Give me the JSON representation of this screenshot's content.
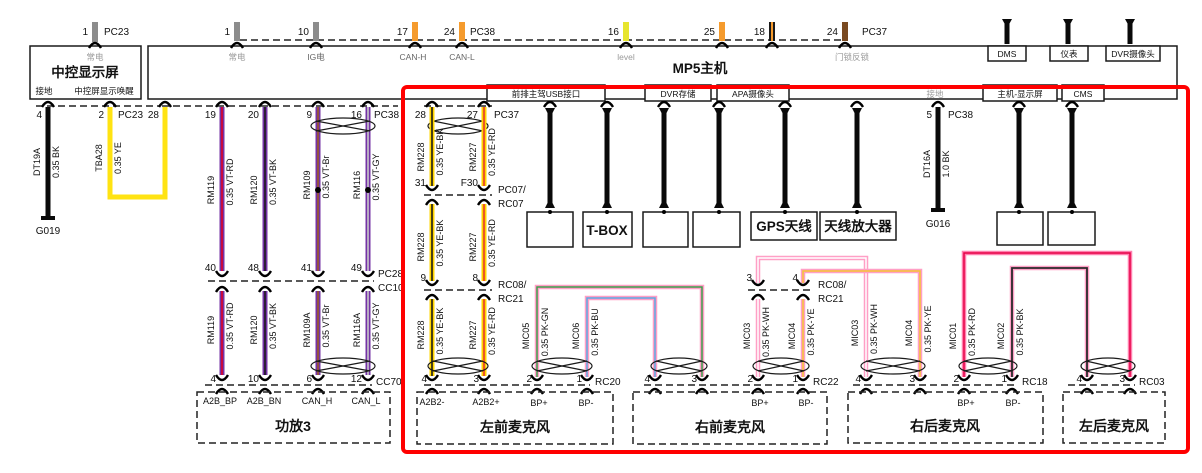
{
  "colors": {
    "red_frame": "#FF0000",
    "violet": "#7433A6",
    "yellow_wire": "#FFD400",
    "pale_yellow": "#FFE312",
    "pink_wire": "#FF9FC6",
    "black_wire": "#0A0A0A",
    "orange_stub": "#F59B2D",
    "brown_stub": "#7A4A21"
  },
  "screen": {
    "top_pin": "1",
    "top_conn": "PC23",
    "power_label": "常电",
    "title": "中控显示屏",
    "gnd_label": "接地",
    "wake_label": "中控屏显示唤醒",
    "pin_gnd": "4",
    "pin_wake": "2",
    "bottom_conn": "PC23"
  },
  "mp5": {
    "title": "MP5主机",
    "pin1": "1",
    "pin1_label": "常电",
    "pin10": "10",
    "pin10_label": "IG电",
    "pin17": "17",
    "pin17_label": "CAN-H",
    "pin24a": "24",
    "pin24a_conn": "PC38",
    "pin24a_label": "CAN-L",
    "pin16": "16",
    "pin16_label": "level",
    "pin25": "25",
    "pin18": "18",
    "pin24b": "24",
    "pin24b_conn": "PC37",
    "pin24b_label": "门锁反锁",
    "box_dms": "DMS",
    "box_cluster": "仪表",
    "box_dvr_cam": "DVR摄像头",
    "box_usb": "前排主驾USB接口",
    "box_dvr_storage": "DVR存储",
    "box_apa": "APA摄像头",
    "gnd_label": "接地",
    "box_host_display": "主机-显示屏",
    "box_cms": "CMS"
  },
  "gnd_left": {
    "pin": "4",
    "name": "DT19A",
    "spec": "0.35 BK",
    "gnd": "G019"
  },
  "wake_wire": {
    "pin": "2",
    "conn": "PC23",
    "name": "TBA28",
    "spec": "0.35 YE",
    "pin_right": "28"
  },
  "purple": {
    "p19": "19",
    "p20": "20",
    "p9": "9",
    "p16": "16",
    "conn_top": "PC38",
    "w1": {
      "name": "RM119",
      "spec": "0.35 VT-RD"
    },
    "w2": {
      "name": "RM120",
      "spec": "0.35 VT-BK"
    },
    "w3": {
      "name": "RM109",
      "spec": "0.35 VT-Br"
    },
    "w4": {
      "name": "RM116",
      "spec": "0.35 VT-GY"
    },
    "m40": "40",
    "m48": "48",
    "m41": "41",
    "m49": "49",
    "conn_mid_a": "PC28",
    "conn_mid_b": "CC10",
    "w1b": {
      "name": "RM119",
      "spec": "0.35 VT-RD"
    },
    "w2b": {
      "name": "RM120",
      "spec": "0.35 VT-BK"
    },
    "w3b": {
      "name": "RM109A",
      "spec": "0.35 VT-Br"
    },
    "w4b": {
      "name": "RM116A",
      "spec": "0.35 VT-GY"
    },
    "b4": "4",
    "b10": "10",
    "b6": "6",
    "b12": "12",
    "conn_bot": "CC70"
  },
  "amp": {
    "title": "功放3",
    "l1": "A2B_BP",
    "l2": "A2B_BN",
    "l3": "CAN_H",
    "l4": "CAN_L"
  },
  "a2b": {
    "p28": "28",
    "p27": "27",
    "conn_top": "PC37",
    "s1w1": {
      "name": "RM228",
      "spec": "0.35 YE-BK"
    },
    "s1w2": {
      "name": "RM227",
      "spec": "0.35 YE-RD"
    },
    "p31": "31",
    "pF30": "F30",
    "conn2a": "PC07/",
    "conn2b": "RC07",
    "s2w1": {
      "name": "RM228",
      "spec": "0.35 YE-BK"
    },
    "s2w2": {
      "name": "RM227",
      "spec": "0.35 YE-RD"
    },
    "p9": "9",
    "p8": "8",
    "conn3a": "RC08/",
    "conn3b": "RC21",
    "s3w1": {
      "name": "RM228",
      "spec": "0.35 YE-BK"
    },
    "s3w2": {
      "name": "RM227",
      "spec": "0.35 YE-RD"
    }
  },
  "mic_lf": {
    "title": "左前麦克风",
    "p4": "4",
    "p3": "3",
    "p2": "2",
    "p1": "1",
    "conn": "RC20",
    "a2b_m": "A2B2-",
    "a2b_p": "A2B2+",
    "bp_p": "BP+",
    "bp_m": "BP-",
    "w1": {
      "name": "MIC05",
      "spec": "0.35 PK-GN"
    },
    "w2": {
      "name": "MIC06",
      "spec": "0.35 PK-BU"
    }
  },
  "mic_rf": {
    "title": "右前麦克风",
    "p4": "4",
    "p3": "3",
    "p2": "2",
    "p1": "1",
    "conn": "RC22",
    "bp_p": "BP+",
    "bp_m": "BP-",
    "w1": {
      "name": "MIC03",
      "spec": "0.35 PK-WH"
    },
    "w2": {
      "name": "MIC04",
      "spec": "0.35 PK-YE"
    },
    "up_p3": "3",
    "up_p4": "4",
    "up_conn_a": "RC08/",
    "up_conn_b": "RC21"
  },
  "mic_rr": {
    "title": "右后麦克风",
    "p4": "4",
    "p3": "3",
    "p2": "2",
    "p1": "1",
    "conn": "RC18",
    "bp_p": "BP+",
    "bp_m": "BP-",
    "in1": {
      "name": "MIC03",
      "spec": "0.35 PK-WH"
    },
    "in2": {
      "name": "MIC04",
      "spec": "0.35 PK-YE"
    },
    "w1": {
      "name": "MIC01",
      "spec": "0.35 PK-RD"
    },
    "w2": {
      "name": "MIC02",
      "spec": "0.35 PK-BK"
    }
  },
  "mic_lr": {
    "title": "左后麦克风",
    "p4": "4",
    "p3": "3",
    "conn": "RC03"
  },
  "devices": {
    "tbox": "T-BOX",
    "gps": "GPS天线",
    "ant_amp": "天线放大器"
  },
  "gnd_right": {
    "pin": "5",
    "conn": "PC38",
    "name": "DT16A",
    "spec": "1.0 BK",
    "gnd": "G016"
  }
}
